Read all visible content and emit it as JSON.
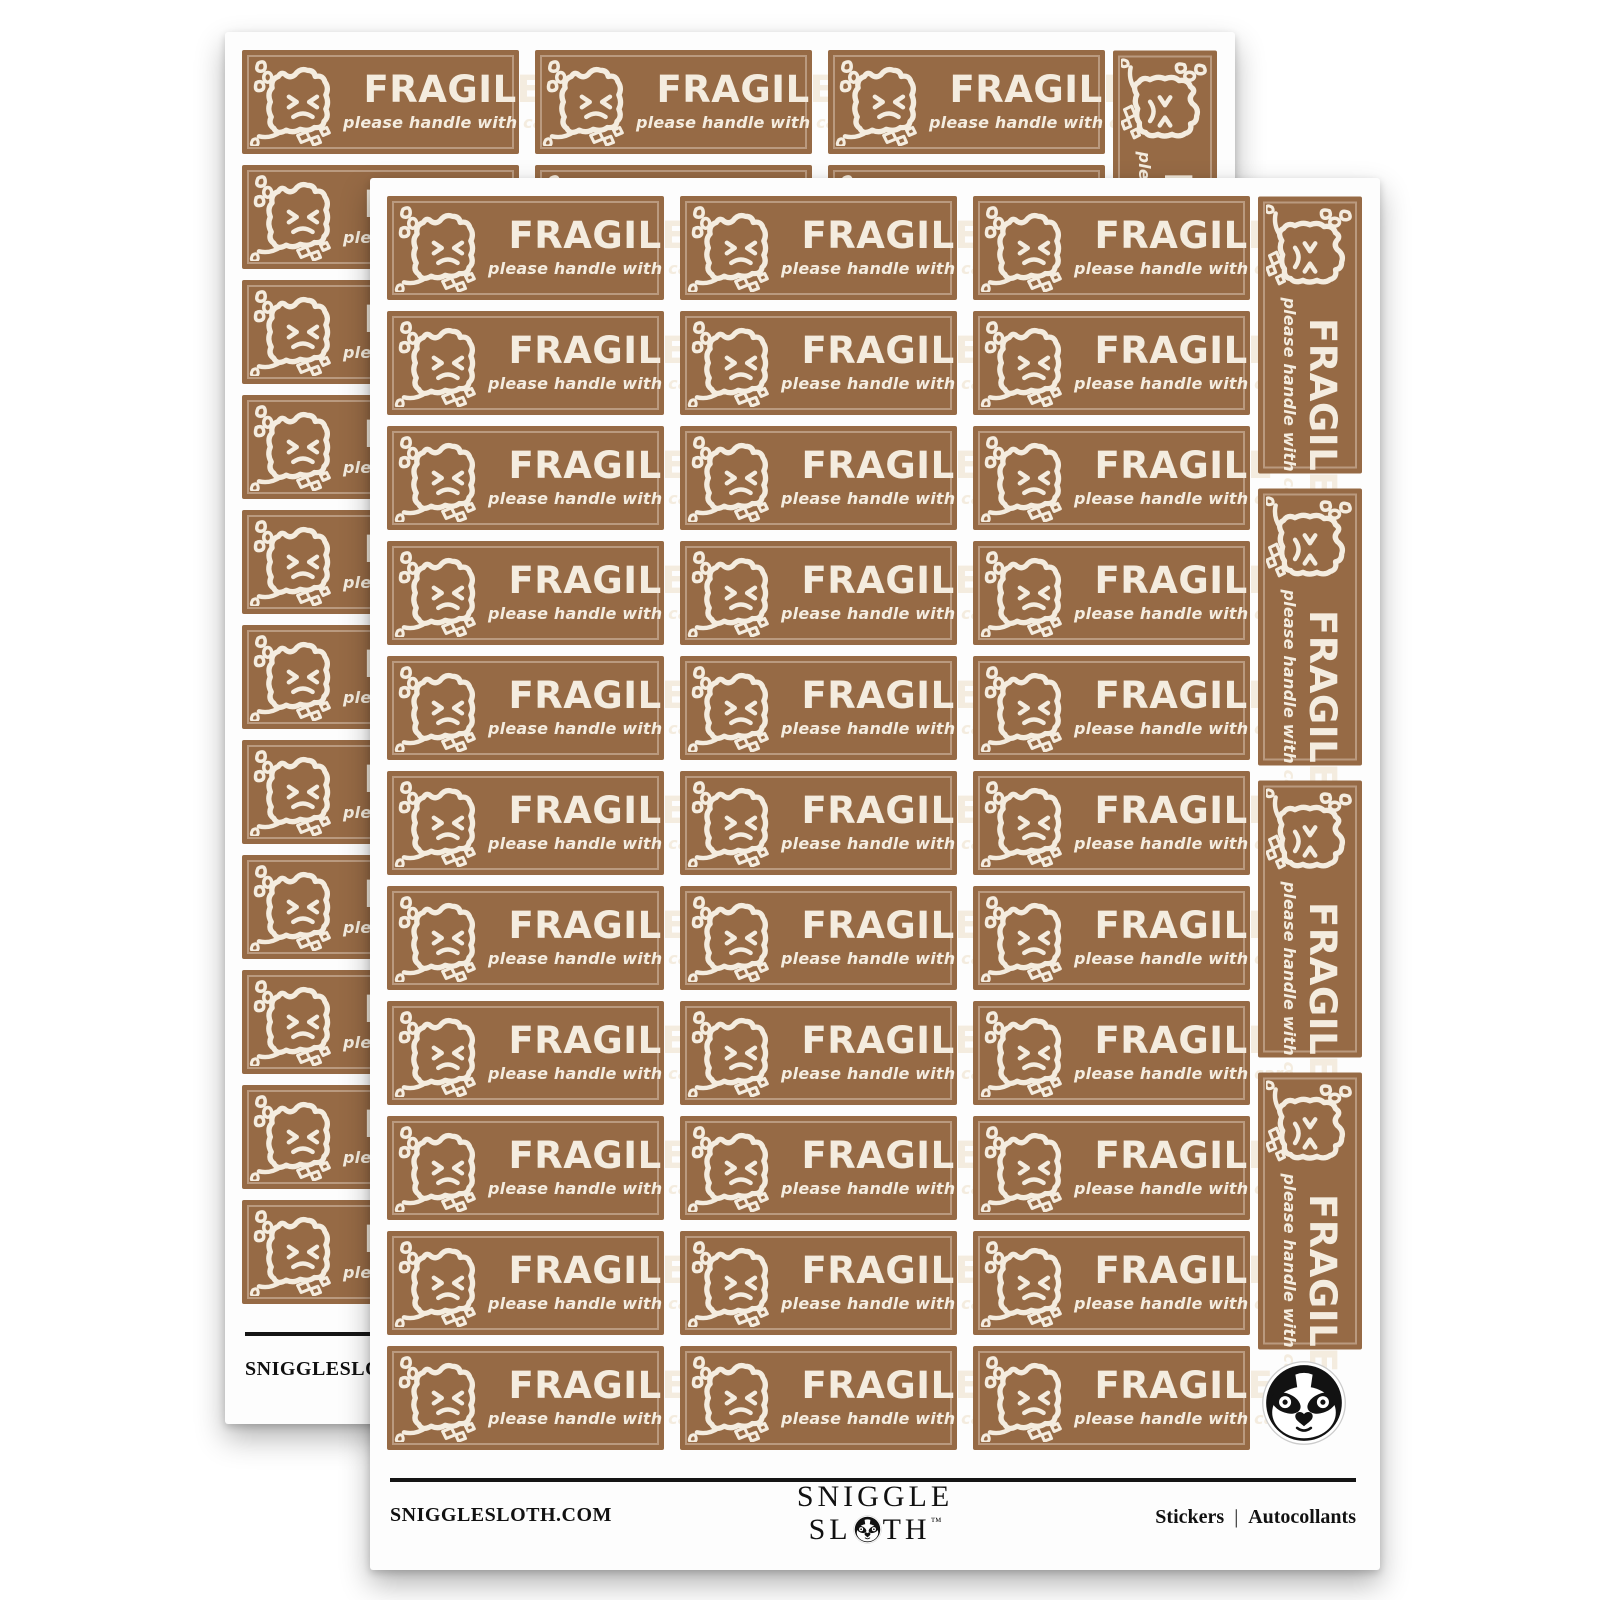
{
  "product": {
    "description": "FRAGILE sticker sheets",
    "sheet_count": 2,
    "sticker": {
      "title": "FRAGILE",
      "subtitle": "please handle with care",
      "bg_color": "#966a45",
      "text_color": "#f4ecdf",
      "icon": "broken-box-face-icon"
    },
    "sheet": {
      "rows": 11,
      "cols": 3,
      "horizontal_sticker_count": 33,
      "vertical_sticker_count": 4,
      "corner_logo": "sloth-face-icon"
    }
  },
  "footer": {
    "website": "SNIGGLESLOTH.COM",
    "brand_top": "SNIGGLE",
    "brand_bottom_left": "SL",
    "brand_bottom_right": "TH",
    "trademark": "™",
    "right_label_en": "Stickers",
    "right_separator": "|",
    "right_label_fr": "Autocollants",
    "line_color": "#151515"
  }
}
